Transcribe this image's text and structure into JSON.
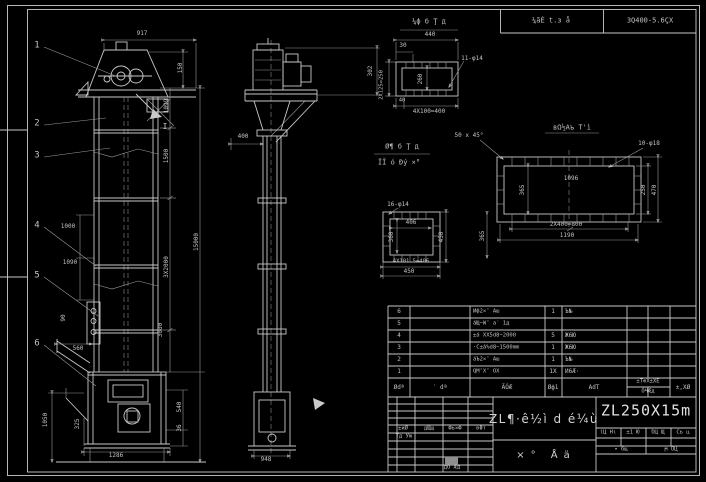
{
  "header": {
    "left": "¼ãÈ t.з å",
    "right": "3Q400-5.6ÇX"
  },
  "balloons": [
    {
      "n": "1",
      "x": 37,
      "y": 46
    },
    {
      "n": "2",
      "x": 37,
      "y": 124
    },
    {
      "n": "3",
      "x": 37,
      "y": 156
    },
    {
      "n": "4",
      "x": 37,
      "y": 226
    },
    {
      "n": "5",
      "x": 37,
      "y": 276
    },
    {
      "n": "6",
      "x": 37,
      "y": 344
    }
  ],
  "labels": [
    {
      "t": "917",
      "x": 142,
      "y": 34
    },
    {
      "t": "150",
      "x": 181,
      "y": 68,
      "r": -90
    },
    {
      "t": "1099",
      "x": 167,
      "y": 106,
      "r": -90
    },
    {
      "t": "1500",
      "x": 167,
      "y": 156,
      "r": -90
    },
    {
      "t": "3X2000",
      "x": 167,
      "y": 267,
      "r": -90
    },
    {
      "t": "3000",
      "x": 161,
      "y": 330,
      "r": -90
    },
    {
      "t": "15000",
      "x": 197,
      "y": 242,
      "r": -90
    },
    {
      "t": "540",
      "x": 180,
      "y": 407,
      "r": -90
    },
    {
      "t": "36",
      "x": 180,
      "y": 428,
      "r": -90
    },
    {
      "t": "1000",
      "x": 68,
      "y": 227
    },
    {
      "t": "1090",
      "x": 70,
      "y": 263
    },
    {
      "t": "90",
      "x": 64,
      "y": 318,
      "r": -90
    },
    {
      "t": "560",
      "x": 78,
      "y": 349
    },
    {
      "t": "1050",
      "x": 46,
      "y": 420,
      "r": -90
    },
    {
      "t": "325",
      "x": 78,
      "y": 424,
      "r": -90
    },
    {
      "t": "1286",
      "x": 116,
      "y": 456
    },
    {
      "t": "I",
      "x": 165,
      "y": 127,
      "s": 8,
      "n": "section-mark-label"
    },
    {
      "t": "400",
      "x": 243,
      "y": 137
    },
    {
      "t": "302",
      "x": 371,
      "y": 71,
      "r": -90
    },
    {
      "t": "948",
      "x": 266,
      "y": 460
    },
    {
      "t": "¼ф б Ţ д",
      "x": 429,
      "y": 22,
      "s": 7,
      "n": "detail1-title"
    },
    {
      "t": "440",
      "x": 430,
      "y": 35
    },
    {
      "t": "30",
      "x": 403,
      "y": 46
    },
    {
      "t": "2X125=250",
      "x": 382,
      "y": 85,
      "r": -90,
      "s": 5.5
    },
    {
      "t": "260",
      "x": 421,
      "y": 79,
      "r": -90
    },
    {
      "t": "11-φ14",
      "x": 472,
      "y": 59
    },
    {
      "t": "40",
      "x": 402,
      "y": 101,
      "s": 5.5
    },
    {
      "t": "4X100=400",
      "x": 429,
      "y": 112
    },
    {
      "t": "вΩ½Аъ Т'ì",
      "x": 572,
      "y": 128,
      "s": 7,
      "n": "detail2-title"
    },
    {
      "t": "50 x 45°",
      "x": 469,
      "y": 136
    },
    {
      "t": "10-φ18",
      "x": 649,
      "y": 144
    },
    {
      "t": "1096",
      "x": 571,
      "y": 179
    },
    {
      "t": "365",
      "x": 523,
      "y": 190,
      "r": -90
    },
    {
      "t": "250",
      "x": 644,
      "y": 190,
      "r": -90
    },
    {
      "t": "470",
      "x": 655,
      "y": 190,
      "r": -90
    },
    {
      "t": "2X400=800",
      "x": 566,
      "y": 225
    },
    {
      "t": "1190",
      "x": 567,
      "y": 236
    },
    {
      "t": "Ø¶ б Ţ д",
      "x": 402,
      "y": 147,
      "s": 7,
      "n": "detail3-title"
    },
    {
      "t": "ÏĬ ó Ðý ×°",
      "x": 399,
      "y": 163,
      "s": 7,
      "n": "detail3-subtitle"
    },
    {
      "t": "16-φ14",
      "x": 398,
      "y": 205
    },
    {
      "t": "406",
      "x": 411,
      "y": 223
    },
    {
      "t": "360",
      "x": 392,
      "y": 237,
      "r": -90
    },
    {
      "t": "450",
      "x": 442,
      "y": 237,
      "r": -90
    },
    {
      "t": "365",
      "x": 483,
      "y": 236,
      "r": -90
    },
    {
      "t": "4X101.5=406",
      "x": 411,
      "y": 262,
      "s": 5.5
    },
    {
      "t": "450",
      "x": 409,
      "y": 272
    }
  ],
  "bom": {
    "top": 306,
    "row_h": 12,
    "headers": {
      "no": "Ødª",
      "code": "′ dª",
      "name": "ÃÓÆ",
      "qty": "Øф1",
      "mat": "АdТ",
      "wt_top": "±Т⊕Х±ХЕ",
      "wt_bot": "ÓЧÆд",
      "rem": "±,XØ"
    },
    "rows": [
      {
        "no": "6",
        "name": "Иф2×″ Аш",
        "qty": "1",
        "mat": "Ъ№"
      },
      {
        "no": "5",
        "name": "áЩ−W″ a′ 1д",
        "qty": "",
        "mat": ""
      },
      {
        "no": "4",
        "name": "±á XX5d8−2000",
        "qty": "5",
        "mat": "Ж6Ю"
      },
      {
        "no": "3",
        "name": "·С±á%d8−1500mm",
        "qty": "1",
        "mat": "Ж6Ю"
      },
      {
        "no": "2",
        "name": "áЪ2×″ Аш",
        "qty": "1",
        "mat": "Ъ№"
      },
      {
        "no": "1",
        "name": "QΜ″X″ ОХ",
        "qty": "1X",
        "mat": "И6Æ·"
      }
    ]
  },
  "titleblock": {
    "main_title": "ZL¶·ê½ì d é¼ù",
    "model": "ZL250X15m",
    "assembly": "×°  Åä",
    "sig": [
      "±иØ",
      "дЩщ",
      "Фь×Ф",
      "вΦт"
    ],
    "sig_row2": "Тд Ую",
    "bottom_label": "дÓ Æд",
    "right_cells": [
      "ίЦ Нι",
      "±1 Ю",
      "ΌЦ Щ",
      "Сь ц"
    ],
    "right_row2": [
      "• бщ",
      "ϻ ΌЦ"
    ]
  }
}
